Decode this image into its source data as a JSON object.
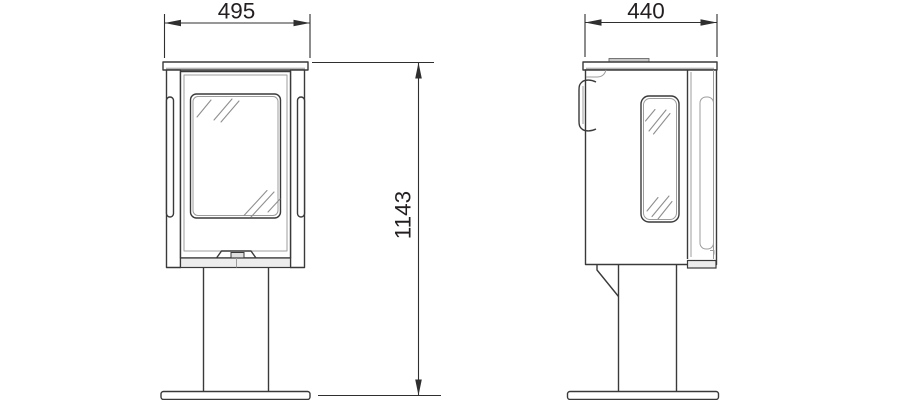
{
  "dimensions": {
    "front_width": {
      "value": "495"
    },
    "side_depth": {
      "value": "440"
    },
    "overall_height": {
      "value": "1143"
    }
  },
  "colors": {
    "line_primary": "#3a3a3a",
    "line_secondary": "#9c9c9c",
    "dimension_line": "#2f2f2f",
    "text": "#231f20",
    "panel_fill": "#ededed",
    "vent_fill": "#c9c9c9",
    "background": "#ffffff"
  }
}
